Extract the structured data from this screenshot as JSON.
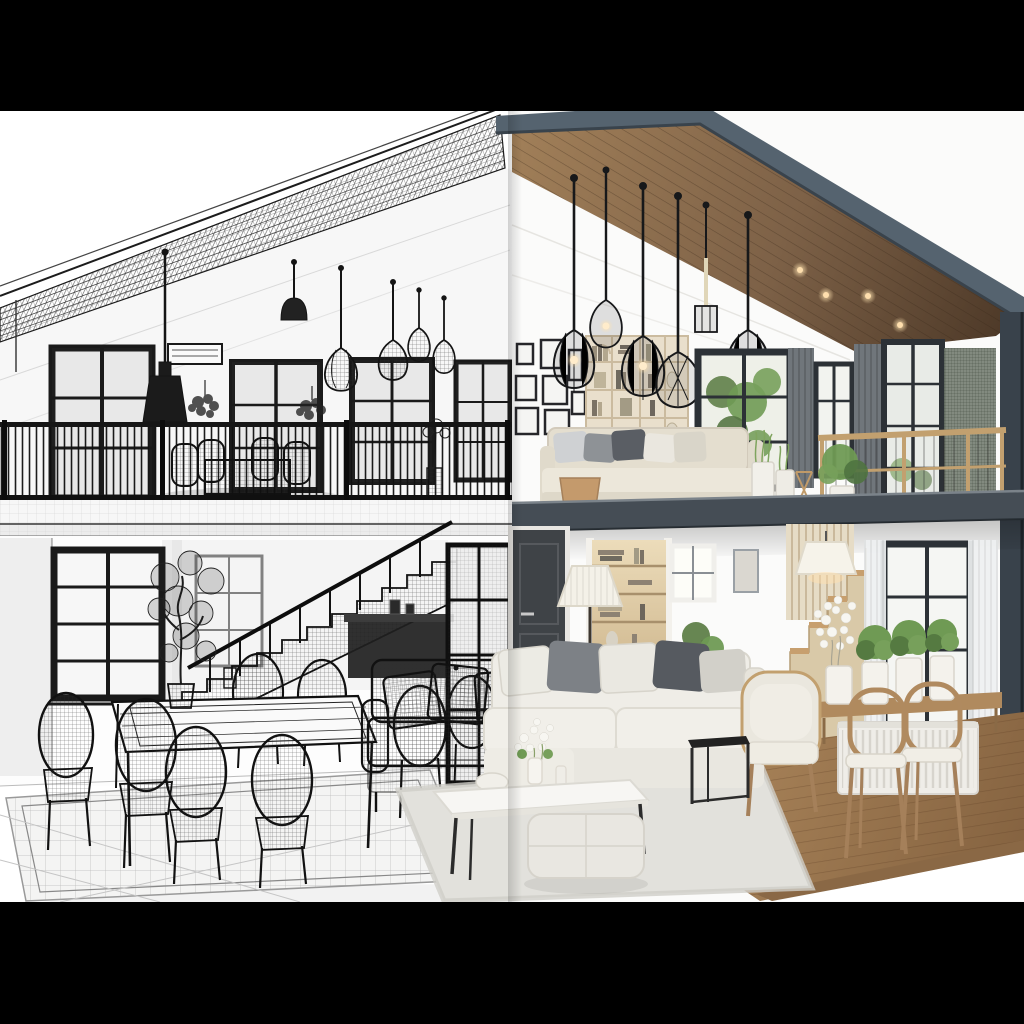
{
  "meta": {
    "description": "Cutaway of a two-story modern house interior, left half drawn as a black-and-white 3D wireframe sketch, right half as a photorealistic render, letterboxed with black bars top and bottom",
    "width": 1024,
    "height": 1024,
    "split": "left wireframe sketch / right photorealistic render"
  },
  "palette": {
    "letterbox": "#000000",
    "paper": "#ffffff",
    "wire_line": "#161616",
    "wire_soft": "#6e6e6e",
    "fascia": "#55636f",
    "fascia_dark": "#39424b",
    "slab": "#454d55",
    "slab_highlight": "#7b838a",
    "wood_ceiling": "#7d6147",
    "wood_ceiling_light": "#a28059",
    "wood_ceiling_dark": "#4c3827",
    "wood_floor": "#a07c55",
    "stair_wood": "#c79f6e",
    "stair_cream": "#d9c9a8",
    "shelf_cream": "#e9dfcc",
    "alcove_wood": "#d8bf94",
    "sofa_white": "#efede7",
    "cushion_gray": "#7d8186",
    "cushion_charcoal": "#565a60",
    "door_charcoal": "#3f4347",
    "window_frame": "#2c3136",
    "curtain_gray": "#70767b",
    "sheer_white": "#eef0f1",
    "plant_green": "#6f9a54",
    "plant_green_dark": "#4f7340",
    "rug_light": "#e2e1dc",
    "rail_wood": "#c2a06f",
    "lamp_glow": "#ffdfae",
    "lamp_shade": "#f4f1e8"
  },
  "scene": {
    "left_wireframe": {
      "style": "black-and-white 3D wireframe sketch",
      "elements": [
        "sloped mesh roof",
        "four black-framed windows",
        "cage pendant lights",
        "wall air-conditioner",
        "hanging plants",
        "balcony railing with table and chairs",
        "floor slab",
        "staircase with handrail",
        "tall window with curtains",
        "glazed partition door",
        "dark counter under stairs",
        "dining table with potted tree",
        "mesh dining chairs",
        "grid-pattern rug",
        "wireframe sofa with plaid cushions"
      ]
    },
    "right_render": {
      "style": "photorealistic interior render",
      "elements": [
        "wood plank cathedral ceiling with downlights",
        "slate roof fascia",
        "black wire cage pendant lamps",
        "gallery wall of black frames",
        "cream shelving unit",
        "loft sofa with gray and white pillows",
        "wooden stool",
        "white pleated planters",
        "wood loft railing",
        "black-framed windows with greenery",
        "gray curtains",
        "steel-blue floor slab",
        "charcoal interior door",
        "lit bookshelf alcove",
        "white floor lamp",
        "green potted plant",
        "wooden staircase",
        "lamp by the stairs",
        "console with potted plants",
        "white radiator",
        "two wooden dining chairs",
        "white fabric sectional sofa",
        "white coffee table with flowers",
        "fabric ottoman",
        "cream armchair",
        "black metal side table",
        "shag rug",
        "wood plank floor and deck"
      ]
    }
  }
}
